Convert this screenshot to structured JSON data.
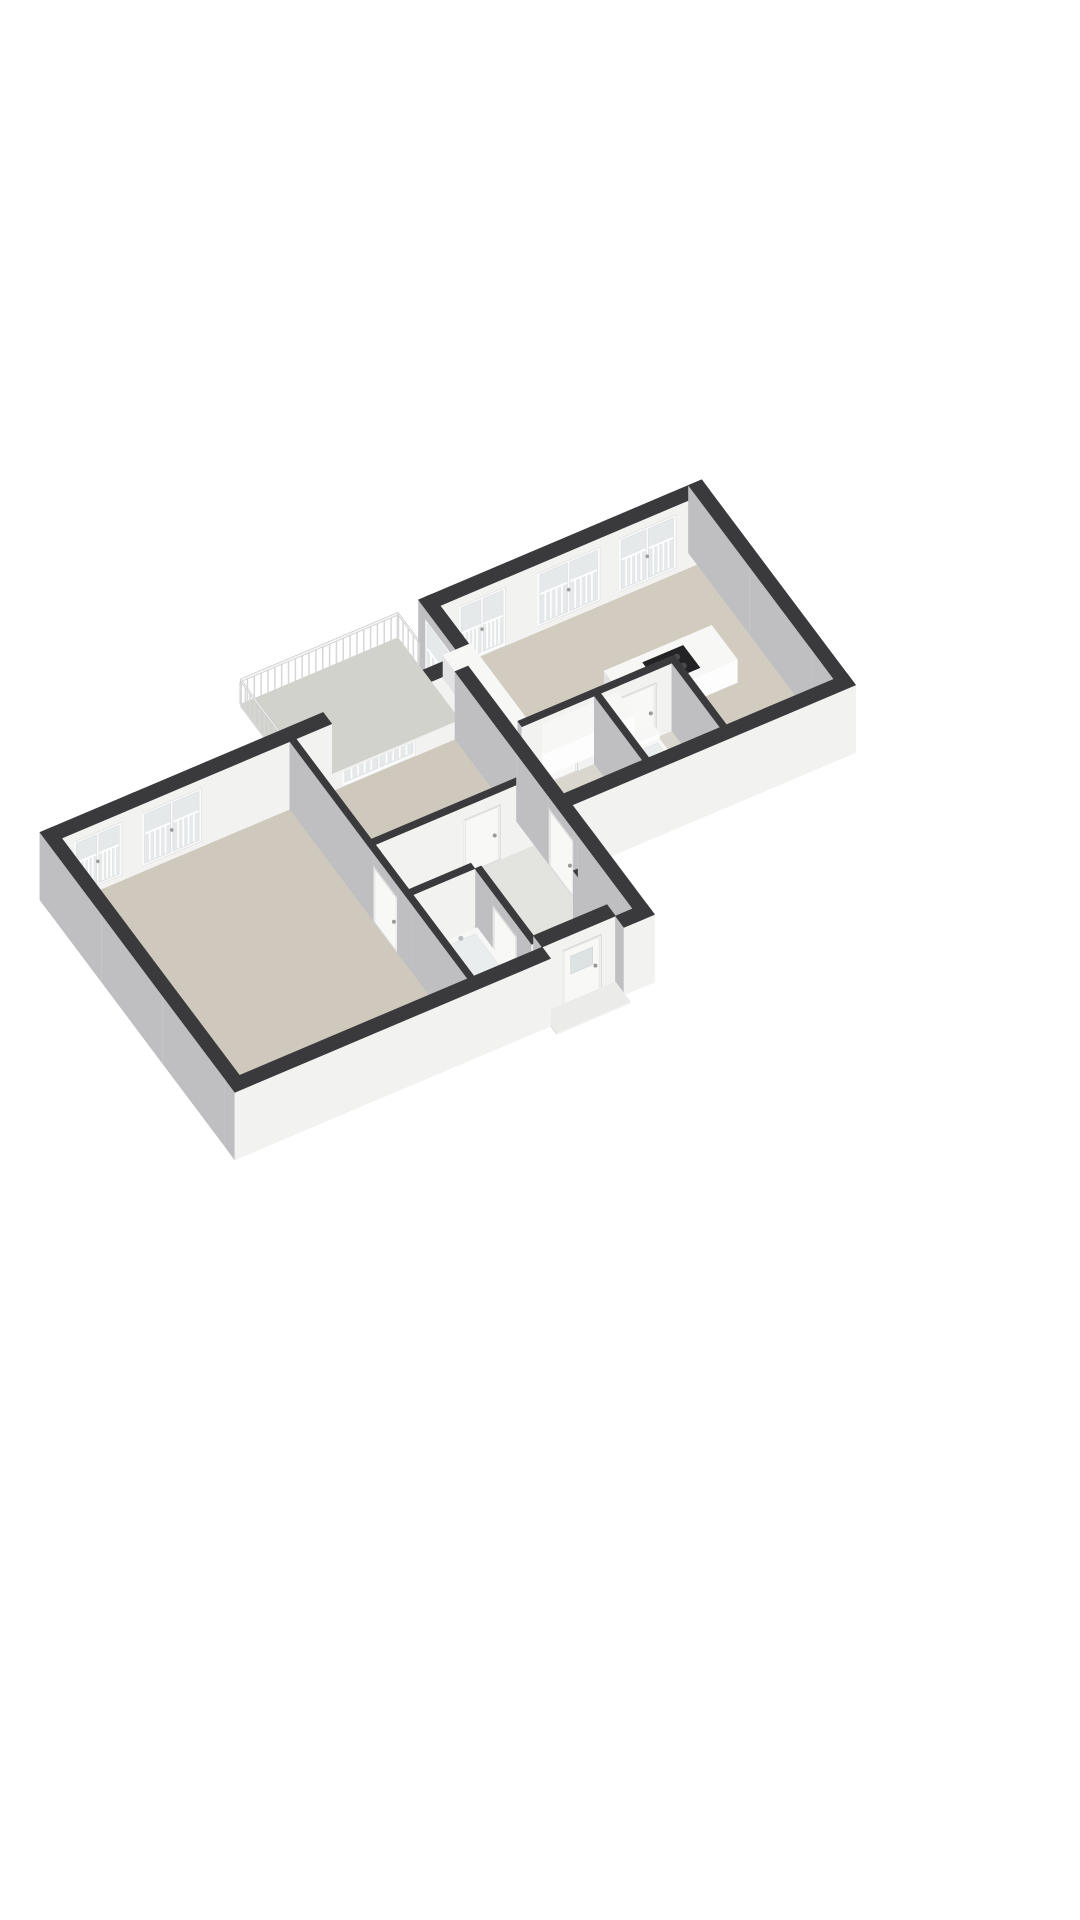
{
  "meta": {
    "title": "3D floor plan of an apartment",
    "background": "#ffffff",
    "view": "isometric-top"
  },
  "projection": {
    "origin": [
      40,
      900
    ],
    "ex": [
      0.92,
      -0.39
    ],
    "ey": [
      0.6,
      0.8
    ],
    "scale": 0.57,
    "height_scale": 0.26,
    "wall_height": 260
  },
  "palette": {
    "wall_top": "#3a3a3c",
    "wall_se": "#f2f2f1",
    "wall_sw": "#bfbfc2",
    "fx_top": "#f7f7f6",
    "fx_se": "#fdfdfd",
    "fx_sw": "#e2e2e4",
    "frame": "#fbfbfb",
    "glass": "#e5e9ea",
    "bar": "#ffffff",
    "leaf": "#f5f5f4",
    "leaf_stroke": "#d5d5d5",
    "handle": "#9a9a9a",
    "cooktop": "#232325",
    "burner": "#4a4a4e",
    "baluster": "#d7d7d7",
    "rail_fill": "#f4f4f4",
    "rail_stroke": "#c8c8c8",
    "tub_inner": "#e9eded",
    "floor_bedroom": "#cfc9bd",
    "floor_living": "#d2ccc0",
    "floor_corridor": "#e3e3e0",
    "floor_bath": "#dcd9d1",
    "floor_small": "#d9d6cd",
    "floor_closet": "#cfcfca",
    "slab_balcony": "#d2d2cd",
    "slab_porch": "#ebebe9",
    "panel_dark": "#333336",
    "panel_red": "#8d3c2c",
    "lowboard_top": "#eae6dc"
  },
  "rooms": [
    {
      "name": "living-room-kitchen"
    },
    {
      "name": "bedroom-1"
    },
    {
      "name": "bedroom-2"
    },
    {
      "name": "corridor-hall"
    },
    {
      "name": "bathroom"
    },
    {
      "name": "toilet-room"
    },
    {
      "name": "storage-room"
    },
    {
      "name": "meter-closet"
    },
    {
      "name": "balcony"
    }
  ],
  "floors": [
    {
      "name": "bedroom-1-floor",
      "color": "floor_bedroom",
      "box": [
        25,
        25,
        460,
        545
      ]
    },
    {
      "name": "bedroom-2-floor",
      "color": "floor_bedroom",
      "box": [
        472,
        25,
        775,
        245
      ]
    },
    {
      "name": "corridor-floor",
      "color": "floor_corridor",
      "poly": [
        [
          472,
          257
        ],
        [
          775,
          257
        ],
        [
          775,
          440
        ],
        [
          730,
          440
        ],
        [
          730,
          520
        ],
        [
          602,
          520
        ],
        [
          602,
          367
        ],
        [
          590,
          367
        ],
        [
          590,
          355
        ],
        [
          472,
          355
        ]
      ]
    },
    {
      "name": "bathroom-floor",
      "color": "floor_bath",
      "box": [
        472,
        367,
        590,
        545
      ]
    },
    {
      "name": "meter-closet-floor",
      "color": "floor_closet",
      "box": [
        742,
        440,
        775,
        520
      ]
    },
    {
      "name": "living-room-floor",
      "color": "floor_living",
      "poly": [
        [
          812,
          -95
        ],
        [
          1315,
          -95
        ],
        [
          1315,
          305
        ],
        [
          1110,
          305
        ],
        [
          1110,
          152
        ],
        [
          812,
          152
        ]
      ]
    },
    {
      "name": "storage-room-floor",
      "color": "floor_small",
      "box": [
        812,
        164,
        950,
        305
      ]
    },
    {
      "name": "toilet-room-floor",
      "color": "floor_small",
      "box": [
        962,
        164,
        1098,
        305
      ]
    }
  ],
  "walls": [
    {
      "name": "wall-l-nw",
      "box": [
        0,
        0,
        812,
        25
      ]
    },
    {
      "name": "wall-step-sw",
      "box": [
        800,
        -120,
        825,
        30
      ]
    },
    {
      "name": "wall-r-nw",
      "box": [
        812,
        -120,
        1340,
        -95
      ]
    },
    {
      "name": "wall-r-ne",
      "box": [
        1315,
        -120,
        1340,
        330
      ]
    },
    {
      "name": "wall-r-se",
      "box": [
        800,
        305,
        1340,
        330
      ]
    },
    {
      "name": "wall-l-sw",
      "box": [
        0,
        0,
        25,
        570
      ]
    },
    {
      "name": "wall-l-se-a",
      "box": [
        0,
        545,
        602,
        570
      ]
    },
    {
      "name": "wall-porch",
      "box": [
        602,
        520,
        742,
        545
      ]
    },
    {
      "name": "wall-l-se-c",
      "box": [
        742,
        545,
        800,
        570
      ]
    },
    {
      "name": "wall-step-ne",
      "box": [
        775,
        25,
        800,
        570
      ]
    },
    {
      "name": "wall-bed1-ne",
      "box": [
        460,
        25,
        472,
        545
      ]
    },
    {
      "name": "wall-bed2-se",
      "box": [
        472,
        245,
        775,
        257
      ]
    },
    {
      "name": "wall-bath-nw",
      "box": [
        472,
        355,
        590,
        367
      ]
    },
    {
      "name": "wall-bath-ne",
      "box": [
        590,
        367,
        602,
        533
      ]
    },
    {
      "name": "wall-small-nw",
      "box": [
        812,
        152,
        1110,
        164
      ]
    },
    {
      "name": "wall-small-mid",
      "box": [
        950,
        164,
        962,
        305
      ]
    },
    {
      "name": "wall-small-e",
      "box": [
        1098,
        164,
        1110,
        305
      ]
    },
    {
      "name": "wall-meter-stub",
      "box": [
        730,
        440,
        742,
        533
      ]
    }
  ],
  "decals": [
    {
      "name": "window-bedroom1-a",
      "wall": "wall-l-nw",
      "face": "+y",
      "u0": 48,
      "u1": 140,
      "z0": 20,
      "z1": 225,
      "type": "window"
    },
    {
      "name": "window-bedroom1-b",
      "wall": "wall-l-nw",
      "face": "+y",
      "u0": 178,
      "u1": 292,
      "z0": 20,
      "z1": 225,
      "type": "window"
    },
    {
      "name": "balcony-doors-bedroom2",
      "wall": "wall-l-nw",
      "face": "+y",
      "u0": 560,
      "u1": 700,
      "z0": 0,
      "z1": 225,
      "type": "glassdoor"
    },
    {
      "name": "balcony-doors-living",
      "wall": "wall-r-nw",
      "face": "+y",
      "u0": 860,
      "u1": 950,
      "z0": 0,
      "z1": 225,
      "type": "glassdoor"
    },
    {
      "name": "window-living-a",
      "wall": "wall-r-nw",
      "face": "+y",
      "u0": 1010,
      "u1": 1130,
      "z0": 20,
      "z1": 225,
      "type": "window"
    },
    {
      "name": "window-living-b",
      "wall": "wall-r-nw",
      "face": "+y",
      "u0": 1165,
      "u1": 1275,
      "z0": 20,
      "z1": 225,
      "type": "window"
    },
    {
      "name": "balcony-door-step",
      "wall": "wall-step-sw",
      "face": "-x",
      "u0": -100,
      "u1": -30,
      "z0": 0,
      "z1": 220,
      "type": "glassdoor1"
    },
    {
      "name": "front-door",
      "wall": "wall-porch",
      "face": "+y",
      "u0": 640,
      "u1": 715,
      "z0": 0,
      "z1": 212,
      "type": "frontdoor"
    },
    {
      "name": "door-bedroom1",
      "wall": "wall-bed1-ne",
      "face": "-x",
      "u0": 270,
      "u1": 340,
      "z0": 0,
      "z1": 210,
      "type": "door"
    },
    {
      "name": "door-bedroom2",
      "wall": "wall-bed2-se",
      "face": "+y",
      "u0": 640,
      "u1": 710,
      "z0": 0,
      "z1": 210,
      "type": "door"
    },
    {
      "name": "door-bathroom",
      "wall": "wall-bath-ne",
      "face": "-x",
      "u0": 420,
      "u1": 490,
      "z0": 0,
      "z1": 210,
      "type": "door"
    },
    {
      "name": "door-living",
      "wall": "wall-step-ne",
      "face": "-x",
      "u0": 300,
      "u1": 372,
      "z0": 0,
      "z1": 215,
      "type": "door"
    },
    {
      "name": "door-storage",
      "wall": "wall-small-nw",
      "face": "+y",
      "u0": 850,
      "u1": 918,
      "z0": 0,
      "z1": 210,
      "type": "door"
    },
    {
      "name": "door-toilet",
      "wall": "wall-small-nw",
      "face": "+y",
      "u0": 1000,
      "u1": 1068,
      "z0": 0,
      "z1": 210,
      "type": "door"
    }
  ],
  "fixtures": [
    {
      "name": "kitchen-island",
      "box": [
        1040,
        55,
        1245,
        130
      ],
      "h": 88,
      "cooktop": [
        1105,
        68,
        1182,
        117
      ]
    },
    {
      "name": "kitchen-counter",
      "box": [
        824,
        100,
        1036,
        150
      ],
      "h": 88
    },
    {
      "name": "kitchen-counter-return",
      "box": [
        824,
        -85,
        876,
        100
      ],
      "h": 88
    },
    {
      "name": "living-lowboard",
      "box": [
        812,
        -88,
        880,
        36
      ],
      "h": 30,
      "top": "lowboard_top"
    },
    {
      "name": "bathtub",
      "box": [
        515,
        377,
        588,
        527
      ],
      "h": 52,
      "inner": 9
    },
    {
      "name": "washbasin",
      "box": [
        478,
        468,
        512,
        522
      ],
      "h": 80,
      "inner": 6
    },
    {
      "name": "toilet-tank",
      "box": [
        1015,
        168,
        1060,
        186
      ],
      "h": 62
    },
    {
      "name": "toilet-bowl",
      "box": [
        1015,
        185,
        1060,
        235
      ],
      "h": 40,
      "inner": 7
    },
    {
      "name": "washing-machine",
      "box": [
        820,
        240,
        876,
        300
      ],
      "h": 85,
      "circle": true
    },
    {
      "name": "meter-panel-dark",
      "box": [
        748,
        450,
        756,
        514
      ],
      "h": 200,
      "solid": "panel_dark"
    },
    {
      "name": "meter-panel-red",
      "box": [
        760,
        452,
        767,
        514
      ],
      "h": 200,
      "solid": "panel_red"
    }
  ],
  "slabs": [
    {
      "name": "balcony-slab",
      "box": [
        500,
        -180,
        800,
        0
      ],
      "h": 10,
      "top": "slab_balcony",
      "railing": true
    },
    {
      "name": "porch-step",
      "box": [
        602,
        545,
        742,
        588
      ],
      "h": 6,
      "top": "slab_porch"
    }
  ],
  "railing": {
    "base_z": 10,
    "top_z": 96,
    "rail_top": 107,
    "spacing": 13,
    "segments": [
      [
        [
          500,
          0
        ],
        [
          500,
          -180
        ]
      ],
      [
        [
          500,
          -180
        ],
        [
          800,
          -180
        ]
      ],
      [
        [
          800,
          -180
        ],
        [
          800,
          -120
        ]
      ]
    ]
  }
}
